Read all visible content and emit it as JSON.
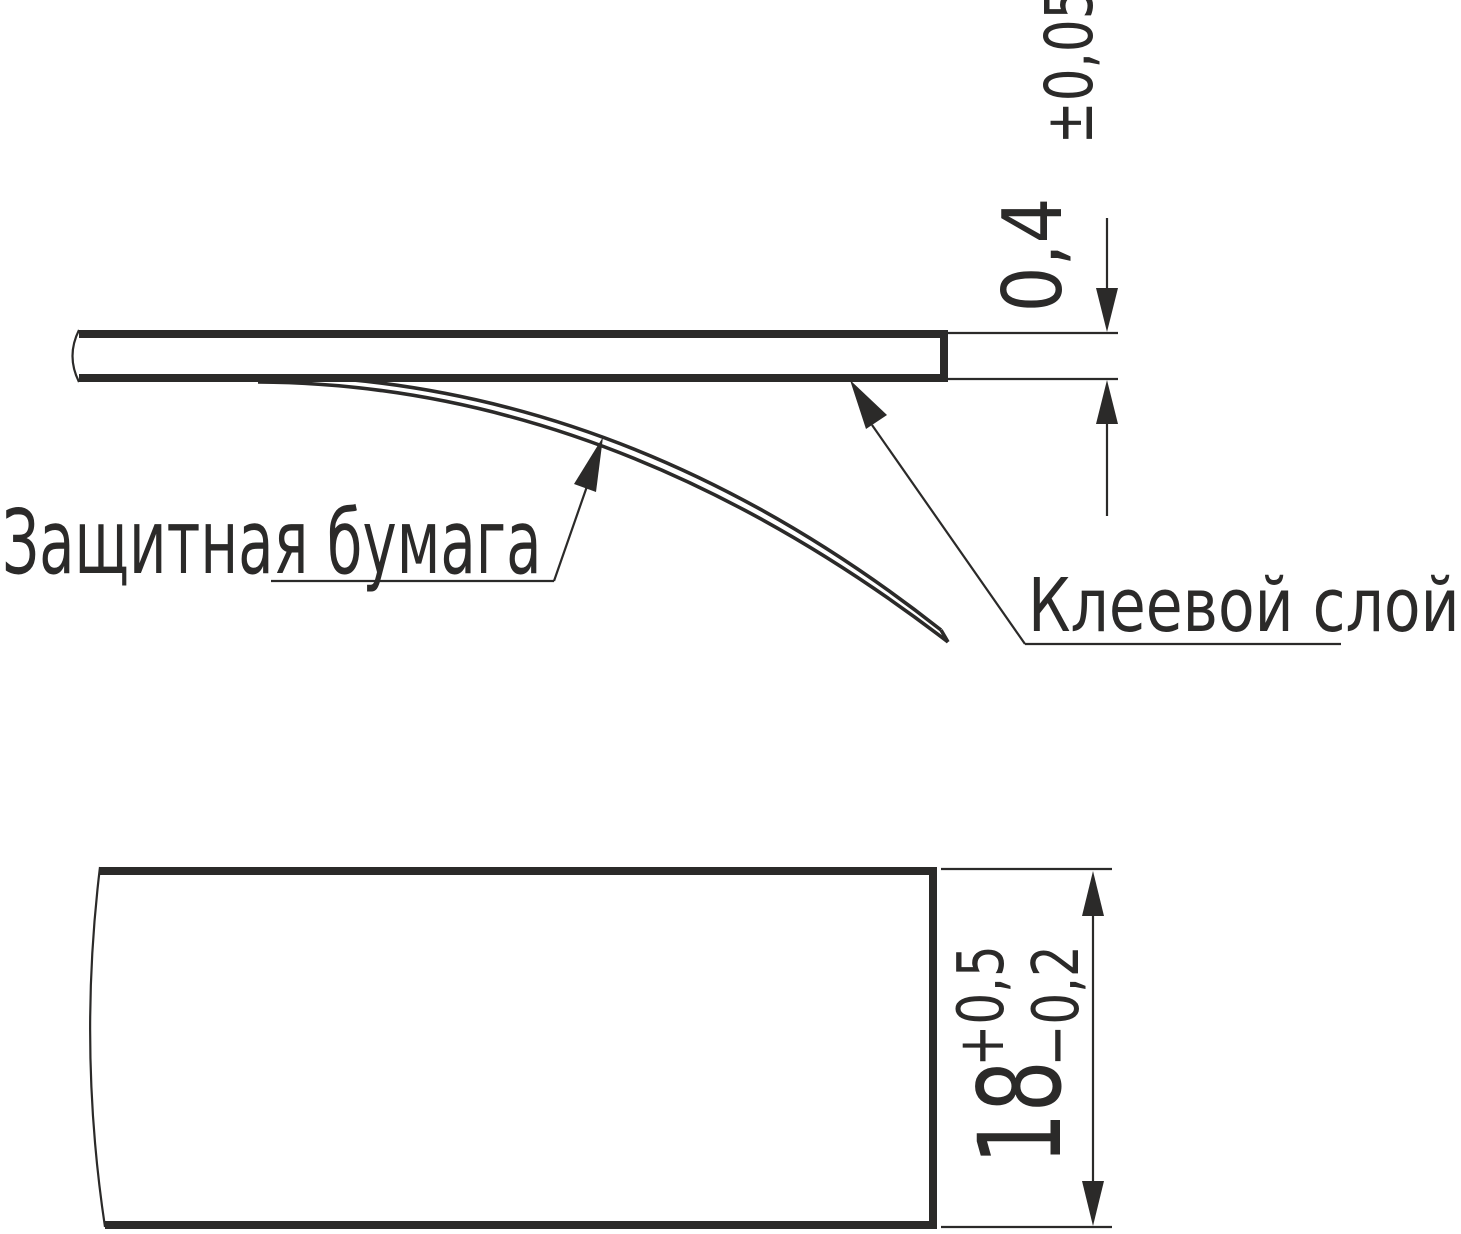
{
  "palette": {
    "ink": "#2b2a29",
    "background": "#ffffff"
  },
  "labels": {
    "protective_paper": "Защитная бумага",
    "adhesive_layer": "Клеевой слой"
  },
  "dimensions": {
    "thickness": {
      "value": "0,4",
      "tolerance": "±0,05"
    },
    "width": {
      "value": "18",
      "tolerance_plus": "+0,5",
      "tolerance_minus": "−0,2"
    }
  }
}
